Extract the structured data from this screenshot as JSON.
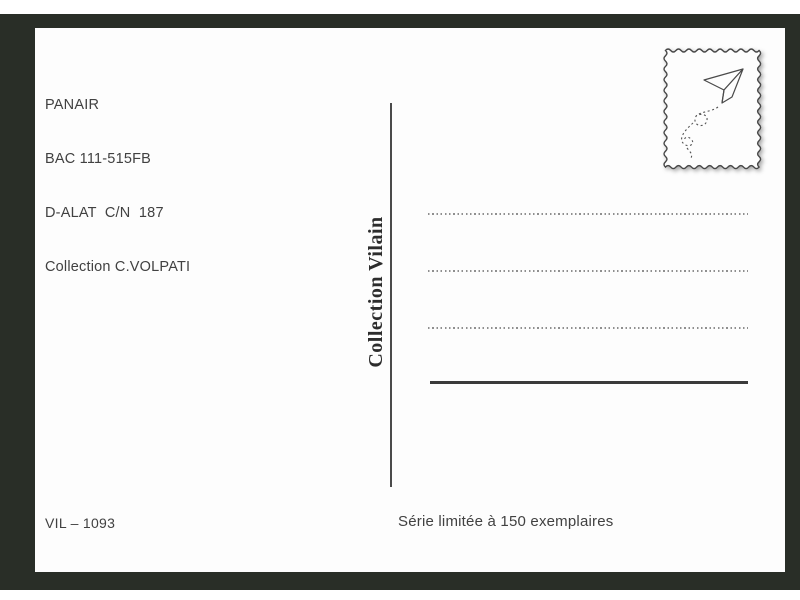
{
  "postcard": {
    "caption": {
      "line1": "PANAIR",
      "line2": "BAC 111-515FB",
      "line3": "D-ALAT  C/N  187",
      "line4": "Collection C.VOLPATI"
    },
    "divider_label": "Collection Vilain",
    "stamp": {
      "icon": "paper-plane-icon"
    },
    "footer": {
      "reference": "VIL – 1093",
      "edition": "Série limitée à 150 exemplaires"
    },
    "colors": {
      "background": "#292e27",
      "card": "#fdfdfd",
      "text": "#414141",
      "dotted_line": "#8f8f8f"
    }
  }
}
